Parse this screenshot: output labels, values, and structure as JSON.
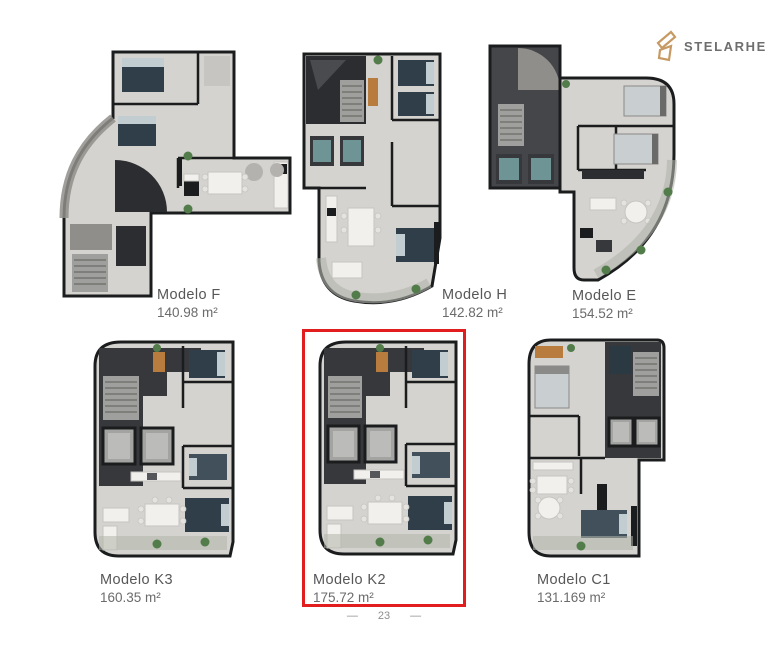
{
  "brand": {
    "name": "STELARHE"
  },
  "colors": {
    "highlight_red": "#e21d1d",
    "logo_gold": "#c79a63",
    "label_gray": "#5d5d5d",
    "footer_gray": "#8f8f8f"
  },
  "models": [
    {
      "key": "f",
      "name": "Modelo F",
      "area": "140.98 m²",
      "highlighted": false
    },
    {
      "key": "h",
      "name": "Modelo H",
      "area": "142.82 m²",
      "highlighted": false
    },
    {
      "key": "e",
      "name": "Modelo E",
      "area": "154.52 m²",
      "highlighted": false
    },
    {
      "key": "k3",
      "name": "Modelo K3",
      "area": "160.35 m²",
      "highlighted": false
    },
    {
      "key": "k2",
      "name": "Modelo K2",
      "area": "175.72 m²",
      "highlighted": true
    },
    {
      "key": "c1",
      "name": "Modelo C1",
      "area": "131.169 m²",
      "highlighted": false
    }
  ],
  "footer": {
    "page_number": "23",
    "dash": "—"
  }
}
